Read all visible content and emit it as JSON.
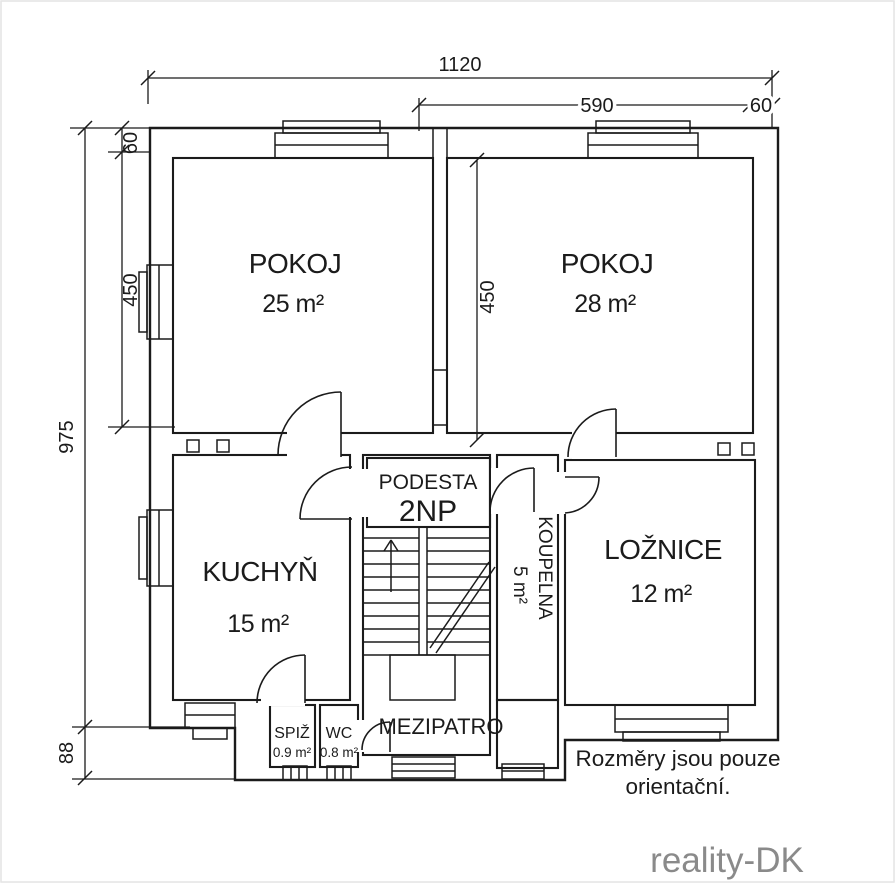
{
  "dims": {
    "top_total": "1120",
    "top_room": "590",
    "top_wall_right": "60",
    "left_total": "975",
    "left_bottom": "88",
    "left_wall_top": "60",
    "left_room": "450",
    "interior_room": "450"
  },
  "rooms": {
    "pokoj1": {
      "name": "POKOJ",
      "area": "25 m²"
    },
    "pokoj2": {
      "name": "POKOJ",
      "area": "28 m²"
    },
    "kuchyn": {
      "name": "KUCHYŇ",
      "area": "15 m²"
    },
    "loznice": {
      "name": "LOŽNICE",
      "area": "12 m²"
    },
    "koupelna": {
      "name": "KOUPELNA",
      "area": "5 m²"
    },
    "spiz": {
      "name": "SPIŽ",
      "area": "0.9 m²"
    },
    "wc": {
      "name": "WC",
      "area": "0.8 m²"
    },
    "podesta": {
      "name": "PODESTA",
      "floor": "2NP"
    },
    "mezipatro": {
      "name": "MEZIPATRO"
    }
  },
  "note": {
    "line1": "Rozměry jsou pouze",
    "line2": "orientační."
  },
  "watermark": "reality-DK"
}
